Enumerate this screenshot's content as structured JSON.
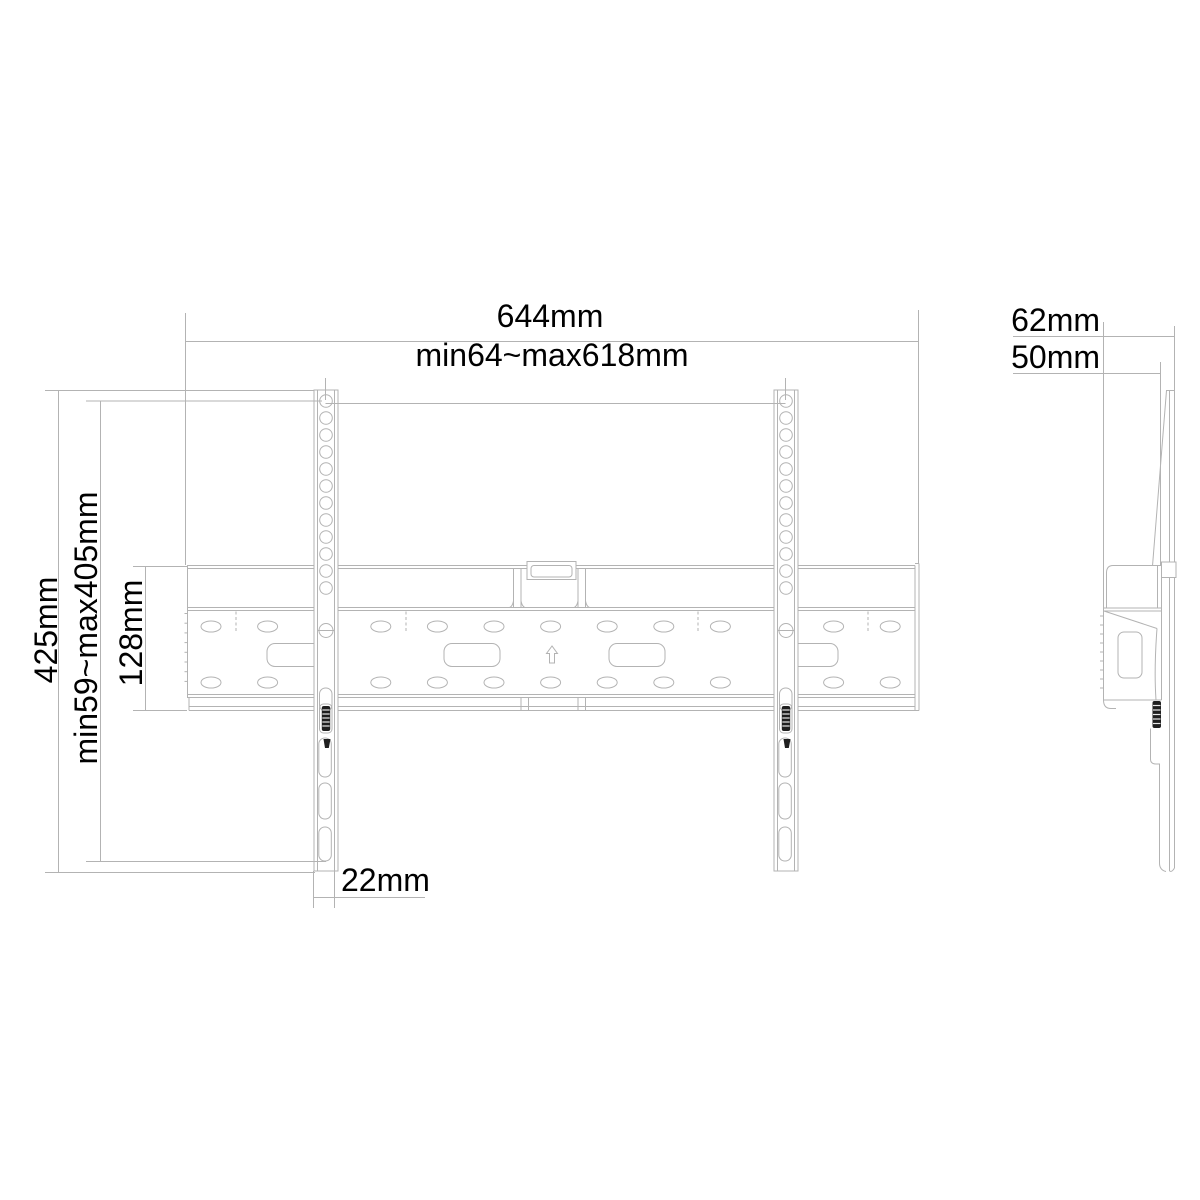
{
  "diagram": {
    "type": "technical-drawing",
    "subject": "TV wall mount bracket - front and side elevation",
    "colors": {
      "line": "#b3b3b3",
      "dark_part": "#1f1f1f",
      "text": "#000000",
      "background": "#ffffff"
    },
    "front_view": {
      "dim_overall_width": "644mm",
      "dim_rail_span": "min64~max618mm",
      "dim_bracket_height": "425mm",
      "dim_vertical_adjust": "min59~max405mm",
      "dim_rail_height": "128mm",
      "dim_bracket_width": "22mm"
    },
    "side_view": {
      "dim_depth_total": "62mm",
      "dim_depth_rail": "50mm"
    }
  }
}
